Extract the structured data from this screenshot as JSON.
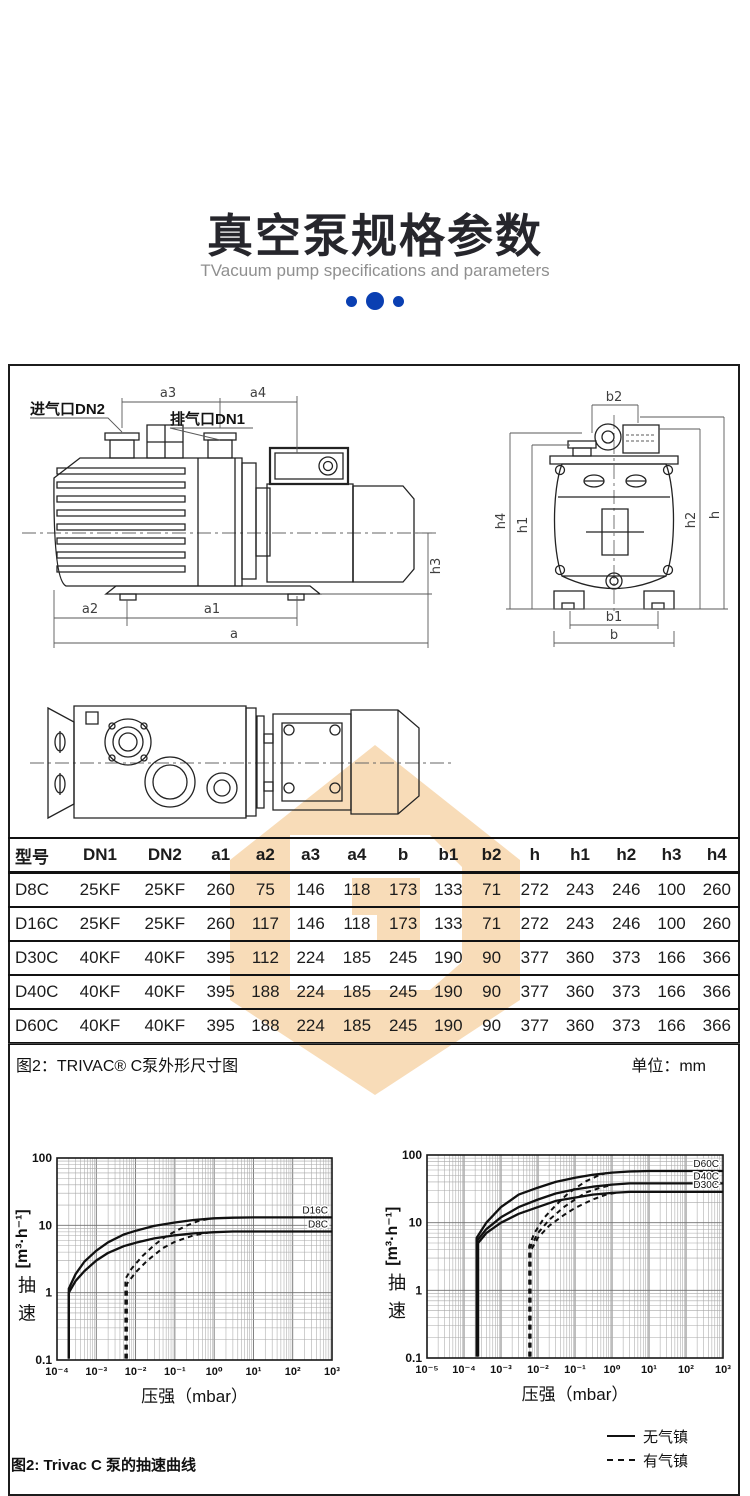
{
  "colors": {
    "accent_blue": "#0a3fb2",
    "watermark": "#f8dcb8",
    "title": "#26262c"
  },
  "header": {
    "title": "真空泵规格参数",
    "subtitle": "TVacuum pump specifications and parameters"
  },
  "drawing": {
    "inlet_label": "进气口DN2",
    "exhaust_label": "排气口DN1",
    "dims": {
      "a": "a",
      "a1": "a1",
      "a2": "a2",
      "a3": "a3",
      "a4": "a4",
      "h3": "h3",
      "b": "b",
      "b1": "b1",
      "b2": "b2",
      "h": "h",
      "h1": "h1",
      "h2": "h2",
      "h4": "h4"
    }
  },
  "table": {
    "headers": [
      "型号",
      "DN1",
      "DN2",
      "a1",
      "a2",
      "a3",
      "a4",
      "b",
      "b1",
      "b2",
      "h",
      "h1",
      "h2",
      "h3",
      "h4"
    ],
    "rows": [
      [
        "D8C",
        "25KF",
        "25KF",
        "260",
        "75",
        "146",
        "118",
        "173",
        "133",
        "71",
        "272",
        "243",
        "246",
        "100",
        "260"
      ],
      [
        "D16C",
        "25KF",
        "25KF",
        "260",
        "117",
        "146",
        "118",
        "173",
        "133",
        "71",
        "272",
        "243",
        "246",
        "100",
        "260"
      ],
      [
        "D30C",
        "40KF",
        "40KF",
        "395",
        "112",
        "224",
        "185",
        "245",
        "190",
        "90",
        "377",
        "360",
        "373",
        "166",
        "366"
      ],
      [
        "D40C",
        "40KF",
        "40KF",
        "395",
        "188",
        "224",
        "185",
        "245",
        "190",
        "90",
        "377",
        "360",
        "373",
        "166",
        "366"
      ],
      [
        "D60C",
        "40KF",
        "40KF",
        "395",
        "188",
        "224",
        "185",
        "245",
        "190",
        "90",
        "377",
        "360",
        "373",
        "166",
        "366"
      ]
    ],
    "caption_left": "图2：TRIVAC® C泵外形尺寸图",
    "caption_right": "单位：mm"
  },
  "chart_data": [
    {
      "type": "line",
      "xscale": "log",
      "yscale": "log",
      "title": "",
      "xlabel": "压强（mbar）",
      "ylabel_cn": "抽速",
      "ylabel_unit": "[m³·h⁻¹]",
      "xlim": [
        0.0001,
        1000
      ],
      "ylim": [
        0.1,
        100
      ],
      "grid": true,
      "legend_position": "none",
      "xticks": [
        "10⁻⁴",
        "10⁻³",
        "10⁻²",
        "10⁻¹",
        "10⁰",
        "10¹",
        "10²",
        "10³"
      ],
      "yticks": [
        "100",
        "10",
        "1",
        "0.1"
      ],
      "series": [
        {
          "name": "D16C",
          "style": "solid",
          "points": [
            [
              0.0002,
              0.105
            ],
            [
              0.0002,
              1.15
            ],
            [
              0.0003,
              1.9
            ],
            [
              0.0005,
              2.9
            ],
            [
              0.001,
              4.2
            ],
            [
              0.002,
              5.6
            ],
            [
              0.005,
              7.3
            ],
            [
              0.01,
              8.3
            ],
            [
              0.03,
              9.8
            ],
            [
              0.1,
              11
            ],
            [
              0.3,
              12
            ],
            [
              1,
              12.7
            ],
            [
              3,
              13
            ],
            [
              10,
              13.1
            ],
            [
              1000,
              13.1
            ]
          ]
        },
        {
          "name": "D8C",
          "style": "solid",
          "points": [
            [
              0.0002,
              0.105
            ],
            [
              0.0002,
              1.0
            ],
            [
              0.0003,
              1.5
            ],
            [
              0.0005,
              2.1
            ],
            [
              0.001,
              3.0
            ],
            [
              0.002,
              3.9
            ],
            [
              0.005,
              4.9
            ],
            [
              0.01,
              5.5
            ],
            [
              0.03,
              6.4
            ],
            [
              0.1,
              7.1
            ],
            [
              0.3,
              7.6
            ],
            [
              1,
              7.9
            ],
            [
              3,
              8.1
            ],
            [
              1000,
              8.1
            ]
          ]
        },
        {
          "name": "D16C 有气镇",
          "style": "dashed",
          "points": [
            [
              0.0055,
              0.105
            ],
            [
              0.0055,
              1.6
            ],
            [
              0.008,
              2.3
            ],
            [
              0.015,
              3.5
            ],
            [
              0.03,
              5.1
            ],
            [
              0.06,
              6.9
            ],
            [
              0.1,
              8.1
            ],
            [
              0.2,
              9.9
            ],
            [
              0.4,
              11.6
            ],
            [
              0.7,
              12.4
            ]
          ]
        },
        {
          "name": "D8C 有气镇",
          "style": "dashed",
          "points": [
            [
              0.006,
              0.105
            ],
            [
              0.006,
              1.35
            ],
            [
              0.01,
              2.0
            ],
            [
              0.02,
              3.0
            ],
            [
              0.05,
              4.6
            ],
            [
              0.1,
              5.7
            ],
            [
              0.3,
              7.1
            ],
            [
              0.7,
              7.8
            ]
          ]
        }
      ]
    },
    {
      "type": "line",
      "xscale": "log",
      "yscale": "log",
      "title": "",
      "xlabel": "压强（mbar）",
      "ylabel_cn": "抽速",
      "ylabel_unit": "[m³·h⁻¹]",
      "xlim": [
        1e-05,
        1000
      ],
      "ylim": [
        0.1,
        100
      ],
      "grid": true,
      "legend_position": "none",
      "xticks": [
        "10⁻⁵",
        "10⁻⁴",
        "10⁻³",
        "10⁻²",
        "10⁻¹",
        "10⁰",
        "10¹",
        "10²",
        "10³"
      ],
      "yticks": [
        "100",
        "10",
        "1",
        "0.1"
      ],
      "series": [
        {
          "name": "D60C",
          "style": "solid",
          "points": [
            [
              0.00022,
              0.105
            ],
            [
              0.00022,
              6
            ],
            [
              0.0004,
              10
            ],
            [
              0.001,
              17
            ],
            [
              0.003,
              26
            ],
            [
              0.01,
              33
            ],
            [
              0.03,
              40
            ],
            [
              0.1,
              46
            ],
            [
              0.3,
              51
            ],
            [
              1,
              55
            ],
            [
              3,
              57
            ],
            [
              10,
              58
            ],
            [
              1000,
              58
            ]
          ]
        },
        {
          "name": "D40C",
          "style": "solid",
          "points": [
            [
              0.00023,
              0.105
            ],
            [
              0.00023,
              5.5
            ],
            [
              0.0004,
              8
            ],
            [
              0.001,
              12
            ],
            [
              0.003,
              17
            ],
            [
              0.01,
              22
            ],
            [
              0.03,
              27
            ],
            [
              0.1,
              31
            ],
            [
              0.3,
              34
            ],
            [
              1,
              36.5
            ],
            [
              3,
              38
            ],
            [
              1000,
              38
            ]
          ]
        },
        {
          "name": "D30C",
          "style": "solid",
          "points": [
            [
              0.00024,
              0.105
            ],
            [
              0.00024,
              5
            ],
            [
              0.0004,
              7
            ],
            [
              0.001,
              10
            ],
            [
              0.003,
              13.5
            ],
            [
              0.01,
              17
            ],
            [
              0.03,
              21
            ],
            [
              0.1,
              23.5
            ],
            [
              0.3,
              26
            ],
            [
              1,
              27.5
            ],
            [
              3,
              28.5
            ],
            [
              1000,
              28.5
            ]
          ]
        },
        {
          "name": "D60C 有气镇",
          "style": "dashed",
          "points": [
            [
              0.0058,
              0.105
            ],
            [
              0.0058,
              4.5
            ],
            [
              0.008,
              7
            ],
            [
              0.015,
              12
            ],
            [
              0.03,
              18
            ],
            [
              0.06,
              26
            ],
            [
              0.1,
              32
            ],
            [
              0.2,
              41
            ],
            [
              0.4,
              49
            ],
            [
              0.7,
              54
            ]
          ]
        },
        {
          "name": "D40C 有气镇",
          "style": "dashed",
          "points": [
            [
              0.006,
              0.105
            ],
            [
              0.006,
              4.2
            ],
            [
              0.01,
              7
            ],
            [
              0.02,
              11
            ],
            [
              0.05,
              17
            ],
            [
              0.1,
              22
            ],
            [
              0.2,
              28
            ],
            [
              0.5,
              33
            ],
            [
              1,
              36
            ]
          ]
        },
        {
          "name": "D30C 有气镇",
          "style": "dashed",
          "points": [
            [
              0.0063,
              0.105
            ],
            [
              0.0063,
              3.8
            ],
            [
              0.01,
              6
            ],
            [
              0.02,
              9
            ],
            [
              0.05,
              13
            ],
            [
              0.1,
              16.5
            ],
            [
              0.3,
              22
            ],
            [
              0.7,
              26
            ],
            [
              1.5,
              28
            ]
          ]
        }
      ]
    }
  ],
  "legend": {
    "items": [
      {
        "line": "solid",
        "label": "无气镇"
      },
      {
        "line": "dashed",
        "label": "有气镇"
      }
    ]
  },
  "figure_caption": "图2:  Trivac C 泵的抽速曲线"
}
